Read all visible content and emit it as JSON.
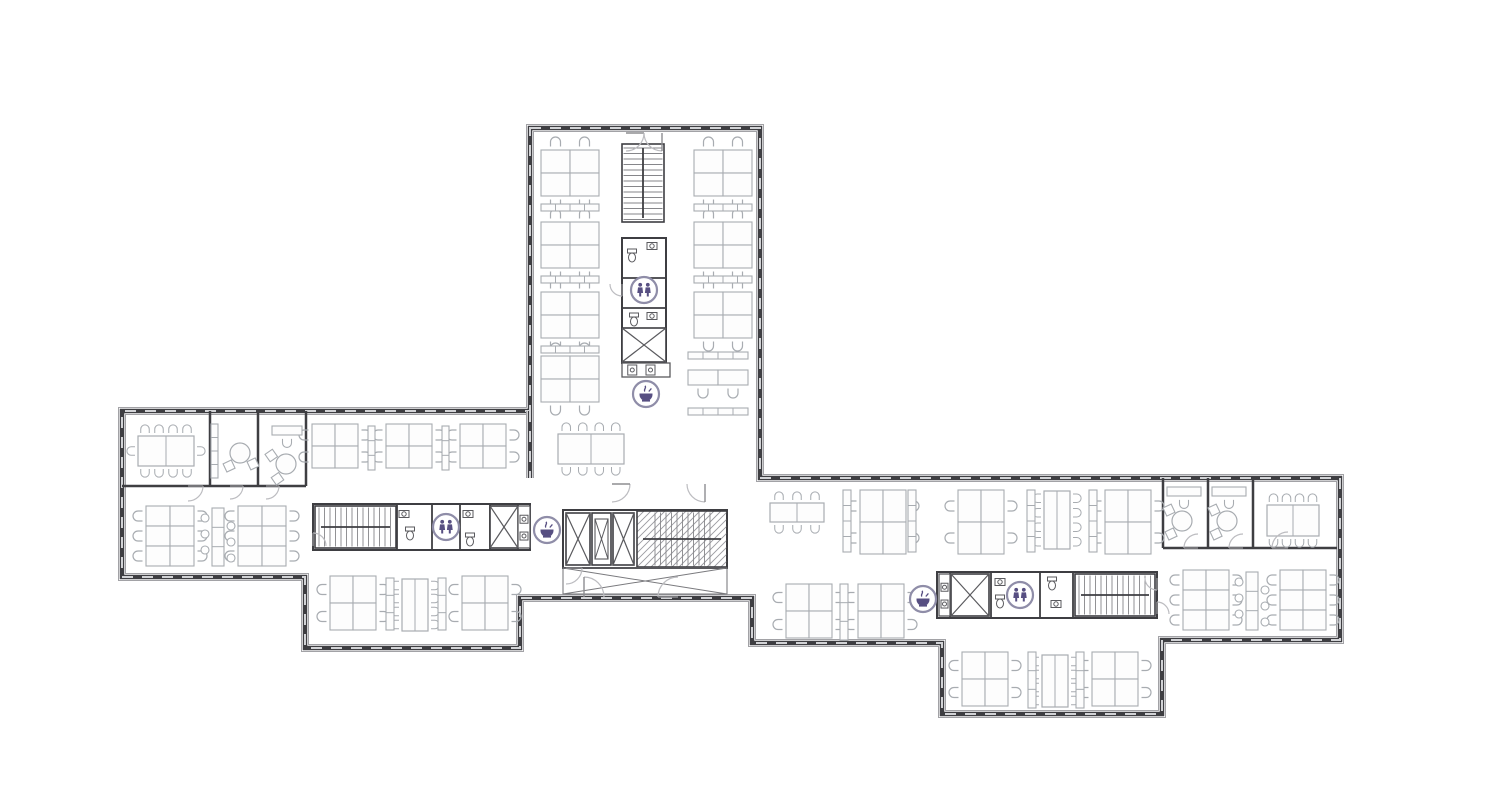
{
  "floor_plan": {
    "canvas": {
      "w": 1486,
      "h": 811
    },
    "colors": {
      "background": "#ffffff",
      "wall_dark": "#3e3e42",
      "wall_halo": "#a2a2a6",
      "window_dash": "#d2d3d6",
      "partition": "#3e3e42",
      "furniture": "#a8acb1",
      "fixture": "#5a5a5e",
      "stair": "#86868a",
      "door": "#bcbcc0",
      "icon_purple": "#574f82",
      "icon_ring": "#8f8da8"
    },
    "outline": [
      [
        530,
        128
      ],
      [
        760,
        128
      ],
      [
        760,
        478
      ],
      [
        1340,
        478
      ],
      [
        1340,
        640
      ],
      [
        1162,
        640
      ],
      [
        1162,
        714
      ],
      [
        942,
        714
      ],
      [
        942,
        643
      ],
      [
        752,
        643
      ],
      [
        752,
        598
      ],
      [
        520,
        598
      ],
      [
        520,
        648
      ],
      [
        305,
        648
      ],
      [
        305,
        577
      ],
      [
        122,
        577
      ],
      [
        122,
        411
      ],
      [
        530,
        411
      ]
    ],
    "facades": [
      [
        530,
        411,
        530,
        478
      ]
    ],
    "walls": [
      [
        122,
        486,
        306,
        486
      ],
      [
        210,
        411,
        210,
        486
      ],
      [
        258,
        411,
        258,
        486
      ],
      [
        306,
        411,
        306,
        486
      ],
      [
        1163,
        478,
        1163,
        548
      ],
      [
        1208,
        478,
        1208,
        548
      ],
      [
        1253,
        478,
        1253,
        548
      ],
      [
        1163,
        548,
        1337,
        548
      ]
    ],
    "rooms": [
      {
        "x": 622,
        "y": 238,
        "w": 44,
        "h": 125,
        "dy": [
          278,
          308
        ]
      },
      {
        "x": 313,
        "y": 504,
        "w": 217,
        "h": 46,
        "dx": [
          397,
          432,
          460,
          490,
          518
        ]
      },
      {
        "x": 937,
        "y": 572,
        "w": 220,
        "h": 46,
        "dx": [
          950,
          991,
          1040,
          1073
        ]
      },
      {
        "x": 563,
        "y": 510,
        "w": 164,
        "h": 58
      }
    ],
    "stairs": [
      {
        "x": 622,
        "y": 144,
        "w": 42,
        "h": 78,
        "dir": "v"
      },
      {
        "x": 315,
        "y": 506,
        "w": 81,
        "h": 42,
        "dir": "h"
      },
      {
        "x": 1075,
        "y": 574,
        "w": 80,
        "h": 42,
        "dir": "h"
      },
      {
        "x": 637,
        "y": 511,
        "w": 90,
        "h": 56,
        "dir": "h",
        "hatch": true
      }
    ],
    "elevators": [
      {
        "x": 622,
        "y": 328,
        "w": 44,
        "h": 34
      },
      {
        "x": 490,
        "y": 506,
        "w": 28,
        "h": 42
      },
      {
        "x": 951,
        "y": 574,
        "w": 38,
        "h": 42
      },
      {
        "x": 566,
        "y": 513,
        "w": 24,
        "h": 52
      },
      {
        "x": 592,
        "y": 513,
        "w": 19,
        "h": 52,
        "inner": true
      },
      {
        "x": 613,
        "y": 513,
        "w": 21,
        "h": 52
      }
    ],
    "xboxes": [
      {
        "x": 563,
        "y": 568,
        "w": 164,
        "h": 26
      }
    ],
    "counters": [
      {
        "x": 622,
        "y": 363,
        "w": 48,
        "h": 14,
        "v": false
      },
      {
        "x": 518,
        "y": 506,
        "w": 12,
        "h": 42,
        "v": true
      },
      {
        "x": 939,
        "y": 574,
        "w": 11,
        "h": 42,
        "v": true
      }
    ],
    "desk_clusters": [
      {
        "x": 541,
        "y": 150,
        "cols": 2,
        "rows": 2,
        "dw": 29,
        "dh": 23,
        "ch": "tb"
      },
      {
        "x": 541,
        "y": 222,
        "cols": 2,
        "rows": 2,
        "dw": 29,
        "dh": 23,
        "ch": "tb"
      },
      {
        "x": 541,
        "y": 292,
        "cols": 2,
        "rows": 2,
        "dw": 29,
        "dh": 23,
        "ch": "tb"
      },
      {
        "x": 541,
        "y": 356,
        "cols": 2,
        "rows": 2,
        "dw": 29,
        "dh": 23,
        "ch": "tb"
      },
      {
        "x": 694,
        "y": 150,
        "cols": 2,
        "rows": 2,
        "dw": 29,
        "dh": 23,
        "ch": "tb"
      },
      {
        "x": 694,
        "y": 222,
        "cols": 2,
        "rows": 2,
        "dw": 29,
        "dh": 23,
        "ch": "tb"
      },
      {
        "x": 694,
        "y": 292,
        "cols": 2,
        "rows": 2,
        "dw": 29,
        "dh": 23,
        "ch": "tb"
      },
      {
        "x": 688,
        "y": 370,
        "cols": 2,
        "rows": 1,
        "dw": 30,
        "dh": 15,
        "ch": "b"
      },
      {
        "x": 312,
        "y": 424,
        "cols": 2,
        "rows": 2,
        "dw": 23,
        "dh": 22,
        "ch": "lr"
      },
      {
        "x": 386,
        "y": 424,
        "cols": 2,
        "rows": 2,
        "dw": 23,
        "dh": 22,
        "ch": "lr"
      },
      {
        "x": 460,
        "y": 424,
        "cols": 2,
        "rows": 2,
        "dw": 23,
        "dh": 22,
        "ch": "lr"
      },
      {
        "x": 146,
        "y": 506,
        "cols": 2,
        "rows": 3,
        "dw": 24,
        "dh": 20,
        "ch": "lr"
      },
      {
        "x": 238,
        "y": 506,
        "cols": 2,
        "rows": 3,
        "dw": 24,
        "dh": 20,
        "ch": "lr"
      },
      {
        "x": 330,
        "y": 576,
        "cols": 2,
        "rows": 2,
        "dw": 23,
        "dh": 27,
        "ch": "lr"
      },
      {
        "x": 462,
        "y": 576,
        "cols": 2,
        "rows": 2,
        "dw": 23,
        "dh": 27,
        "ch": "lr"
      },
      {
        "x": 860,
        "y": 490,
        "cols": 2,
        "rows": 2,
        "dw": 23,
        "dh": 32,
        "ch": "lr"
      },
      {
        "x": 958,
        "y": 490,
        "cols": 2,
        "rows": 2,
        "dw": 23,
        "dh": 32,
        "ch": "lr"
      },
      {
        "x": 1105,
        "y": 490,
        "cols": 2,
        "rows": 2,
        "dw": 23,
        "dh": 32,
        "ch": "lr"
      },
      {
        "x": 786,
        "y": 584,
        "cols": 2,
        "rows": 2,
        "dw": 23,
        "dh": 27,
        "ch": "lr"
      },
      {
        "x": 858,
        "y": 584,
        "cols": 2,
        "rows": 2,
        "dw": 23,
        "dh": 27,
        "ch": "lr"
      },
      {
        "x": 1183,
        "y": 570,
        "cols": 2,
        "rows": 3,
        "dw": 23,
        "dh": 20,
        "ch": "lr"
      },
      {
        "x": 1280,
        "y": 570,
        "cols": 2,
        "rows": 3,
        "dw": 23,
        "dh": 20,
        "ch": "lr"
      },
      {
        "x": 962,
        "y": 652,
        "cols": 2,
        "rows": 2,
        "dw": 23,
        "dh": 27,
        "ch": "lr"
      },
      {
        "x": 1092,
        "y": 652,
        "cols": 2,
        "rows": 2,
        "dw": 23,
        "dh": 27,
        "ch": "lr"
      }
    ],
    "tables": [
      {
        "x": 558,
        "y": 434,
        "w": 66,
        "h": 30,
        "top": 4,
        "bottom": 4
      },
      {
        "x": 138,
        "y": 436,
        "w": 56,
        "h": 30,
        "top": 4,
        "bottom": 4,
        "left": 1,
        "right": 1
      },
      {
        "x": 402,
        "y": 579,
        "w": 26,
        "h": 52,
        "left": 4,
        "right": 4
      },
      {
        "x": 770,
        "y": 503,
        "w": 54,
        "h": 19,
        "top": 3,
        "bottom": 3
      },
      {
        "x": 1044,
        "y": 491,
        "w": 26,
        "h": 58,
        "left": 4,
        "right": 4
      },
      {
        "x": 1267,
        "y": 505,
        "w": 52,
        "h": 31,
        "top": 4,
        "bottom": 4
      },
      {
        "x": 1042,
        "y": 655,
        "w": 26,
        "h": 52,
        "left": 4,
        "right": 4
      }
    ],
    "round_tables": [
      {
        "x": 240,
        "y": 453,
        "r": 10,
        "chairs": [
          130,
          40
        ]
      },
      {
        "x": 286,
        "y": 464,
        "r": 10,
        "chairs": [
          210,
          120
        ]
      },
      {
        "x": 1182,
        "y": 521,
        "r": 10,
        "chairs": [
          220,
          130
        ]
      },
      {
        "x": 1227,
        "y": 521,
        "r": 10,
        "chairs": [
          220,
          130
        ]
      }
    ],
    "mini_desks": [
      {
        "x": 272,
        "y": 426,
        "w": 30,
        "h": 9
      },
      {
        "x": 1167,
        "y": 487,
        "w": 34,
        "h": 9
      },
      {
        "x": 1212,
        "y": 487,
        "w": 34,
        "h": 9
      }
    ],
    "cabinets": [
      {
        "x": 541,
        "y": 204,
        "w": 58,
        "h": 7,
        "cells": 4
      },
      {
        "x": 541,
        "y": 276,
        "w": 58,
        "h": 7,
        "cells": 4
      },
      {
        "x": 541,
        "y": 346,
        "w": 58,
        "h": 7,
        "cells": 4
      },
      {
        "x": 694,
        "y": 204,
        "w": 58,
        "h": 7,
        "cells": 4
      },
      {
        "x": 694,
        "y": 276,
        "w": 58,
        "h": 7,
        "cells": 4
      },
      {
        "x": 688,
        "y": 352,
        "w": 60,
        "h": 7,
        "cells": 4
      },
      {
        "x": 688,
        "y": 408,
        "w": 60,
        "h": 7,
        "cells": 4
      },
      {
        "x": 211,
        "y": 424,
        "w": 7,
        "h": 54,
        "cells": 4
      },
      {
        "x": 368,
        "y": 426,
        "w": 7,
        "h": 44,
        "cells": 3
      },
      {
        "x": 442,
        "y": 426,
        "w": 7,
        "h": 44,
        "cells": 3
      },
      {
        "x": 843,
        "y": 490,
        "w": 8,
        "h": 62,
        "cells": 4
      },
      {
        "x": 908,
        "y": 490,
        "w": 8,
        "h": 62,
        "cells": 4
      },
      {
        "x": 1027,
        "y": 490,
        "w": 8,
        "h": 62,
        "cells": 4
      },
      {
        "x": 1089,
        "y": 490,
        "w": 8,
        "h": 62,
        "cells": 4
      },
      {
        "x": 840,
        "y": 584,
        "w": 8,
        "h": 56,
        "cells": 3
      },
      {
        "x": 386,
        "y": 578,
        "w": 8,
        "h": 52,
        "cells": 3
      },
      {
        "x": 438,
        "y": 578,
        "w": 8,
        "h": 52,
        "cells": 3
      },
      {
        "x": 1028,
        "y": 652,
        "w": 8,
        "h": 56,
        "cells": 3
      },
      {
        "x": 1076,
        "y": 652,
        "w": 8,
        "h": 56,
        "cells": 3
      }
    ],
    "stool_strips": [
      {
        "x": 212,
        "y": 508,
        "w": 12,
        "h": 58
      },
      {
        "x": 1246,
        "y": 572,
        "w": 12,
        "h": 58
      }
    ],
    "fixtures": [
      {
        "t": "wc",
        "x": 632,
        "y": 256
      },
      {
        "t": "sink",
        "x": 652,
        "y": 246
      },
      {
        "t": "wc",
        "x": 634,
        "y": 320
      },
      {
        "t": "sink",
        "x": 652,
        "y": 316
      },
      {
        "t": "wc",
        "x": 410,
        "y": 534
      },
      {
        "t": "sink",
        "x": 404,
        "y": 514
      },
      {
        "t": "wc",
        "x": 470,
        "y": 540
      },
      {
        "t": "sink",
        "x": 468,
        "y": 514
      },
      {
        "t": "wc",
        "x": 1000,
        "y": 602
      },
      {
        "t": "sink",
        "x": 1000,
        "y": 582
      },
      {
        "t": "wc",
        "x": 1052,
        "y": 584
      },
      {
        "t": "sink",
        "x": 1056,
        "y": 604
      }
    ],
    "doors": [
      {
        "x": 626,
        "y": 133,
        "r": 18,
        "rot": 0
      },
      {
        "x": 662,
        "y": 133,
        "r": 18,
        "rot": 90
      },
      {
        "x": 612,
        "y": 484,
        "r": 18,
        "rot": 0
      },
      {
        "x": 705,
        "y": 484,
        "r": 18,
        "rot": 90
      },
      {
        "x": 584,
        "y": 597,
        "r": 20,
        "rot": 270
      },
      {
        "x": 678,
        "y": 597,
        "r": 20,
        "rot": 180
      },
      {
        "x": 188,
        "y": 486,
        "r": 15,
        "rot": 0
      },
      {
        "x": 230,
        "y": 486,
        "r": 13,
        "rot": 0
      },
      {
        "x": 266,
        "y": 486,
        "r": 13,
        "rot": 0
      },
      {
        "x": 1198,
        "y": 548,
        "r": 14,
        "rot": 180
      },
      {
        "x": 1243,
        "y": 548,
        "r": 14,
        "rot": 180
      },
      {
        "x": 1288,
        "y": 548,
        "r": 16,
        "rot": 180
      },
      {
        "x": 313,
        "y": 546,
        "r": 13,
        "rot": 270
      },
      {
        "x": 1157,
        "y": 578,
        "r": 12,
        "rot": 90
      },
      {
        "x": 1157,
        "y": 614,
        "r": 12,
        "rot": 270
      },
      {
        "x": 622,
        "y": 284,
        "r": 12,
        "rot": 90
      },
      {
        "x": 566,
        "y": 568,
        "r": 16,
        "rot": 0
      }
    ],
    "icons": [
      {
        "kind": "restroom",
        "x": 644,
        "y": 290
      },
      {
        "kind": "coffee",
        "x": 646,
        "y": 394
      },
      {
        "kind": "restroom",
        "x": 446,
        "y": 527
      },
      {
        "kind": "coffee",
        "x": 547,
        "y": 530
      },
      {
        "kind": "coffee",
        "x": 923,
        "y": 599
      },
      {
        "kind": "restroom",
        "x": 1020,
        "y": 595
      }
    ]
  }
}
